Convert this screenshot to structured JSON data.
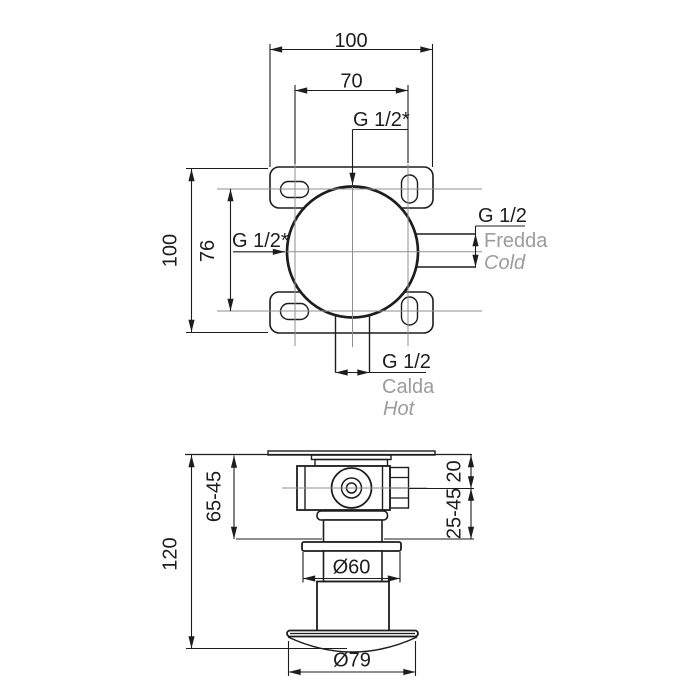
{
  "drawing": {
    "type": "technical-installation-diagram",
    "product": "concealed-shower-mixer-valve",
    "top_view": {
      "dim_overall_width": "100",
      "dim_port_spacing": "70",
      "dim_slot_spacing": "76",
      "dim_overall_height": "100",
      "outlet_top_label": "G 1/2*",
      "outlet_left_label": "G 1/2*",
      "inlet_cold": {
        "thread": "G 1/2",
        "label_it": "Fredda",
        "label_en": "Cold"
      },
      "inlet_hot": {
        "thread": "G 1/2",
        "label_it": "Calda",
        "label_en": "Hot"
      }
    },
    "side_view": {
      "dim_total_depth": "120",
      "dim_rough_in_depth": "65-45",
      "dim_center_offset": "20",
      "dim_adjustment_range": "25-45",
      "dim_flange_diameter": "Ø60",
      "dim_trim_plate_diameter": "Ø79"
    }
  },
  "colors": {
    "line": "#1d1d1d",
    "centerline": "#8f8f8f",
    "muted_text": "#9c9c9c",
    "background": "#ffffff"
  }
}
